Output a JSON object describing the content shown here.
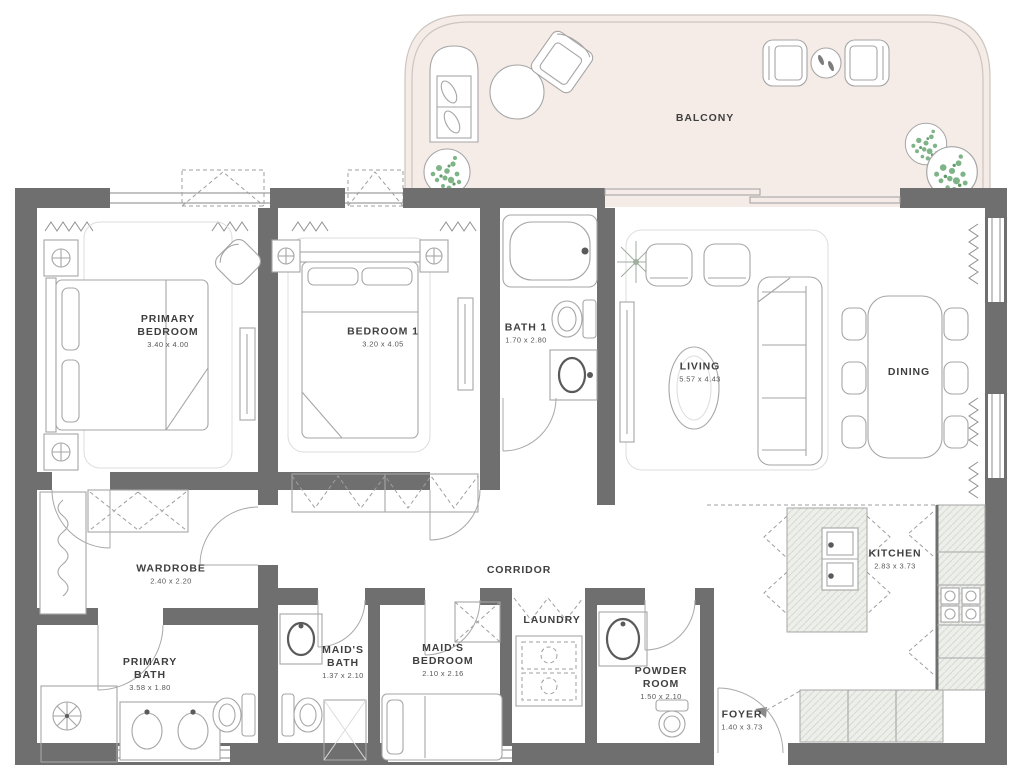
{
  "palette": {
    "wall": "#6f6f6f",
    "furniture_line": "#a6a6a6",
    "balcony_fill": "#f5ece8",
    "balcony_line": "#ccc5bf",
    "counter_fill": "#edf0ea",
    "plant_green": "#7eb487",
    "label_text": "#3f3f3f"
  },
  "rooms": {
    "primary_bedroom": {
      "name": "PRIMARY\nBEDROOM",
      "dims": "3.40 x 4.00"
    },
    "bedroom_1": {
      "name": "BEDROOM 1",
      "dims": "3.20 x 4.05"
    },
    "bath_1": {
      "name": "BATH 1",
      "dims": "1.70 x 2.80"
    },
    "living": {
      "name": "LIVING",
      "dims": "5.57 x 4.43"
    },
    "dining": {
      "name": "DINING"
    },
    "balcony": {
      "name": "BALCONY"
    },
    "wardrobe": {
      "name": "WARDROBE",
      "dims": "2.40 x 2.20"
    },
    "corridor": {
      "name": "CORRIDOR"
    },
    "kitchen": {
      "name": "KITCHEN",
      "dims": "2.83 x 3.73"
    },
    "primary_bath": {
      "name": "PRIMARY\nBATH",
      "dims": "3.58 x 1.80"
    },
    "maids_bath": {
      "name": "MAID'S\nBATH",
      "dims": "1.37 x 2.10"
    },
    "maids_bedroom": {
      "name": "MAID'S\nBEDROOM",
      "dims": "2.10 x 2.16"
    },
    "laundry": {
      "name": "LAUNDRY"
    },
    "powder_room": {
      "name": "POWDER\nROOM",
      "dims": "1.50 x 2.10"
    },
    "foyer": {
      "name": "FOYER",
      "dims": "1.40 x 3.73"
    }
  }
}
